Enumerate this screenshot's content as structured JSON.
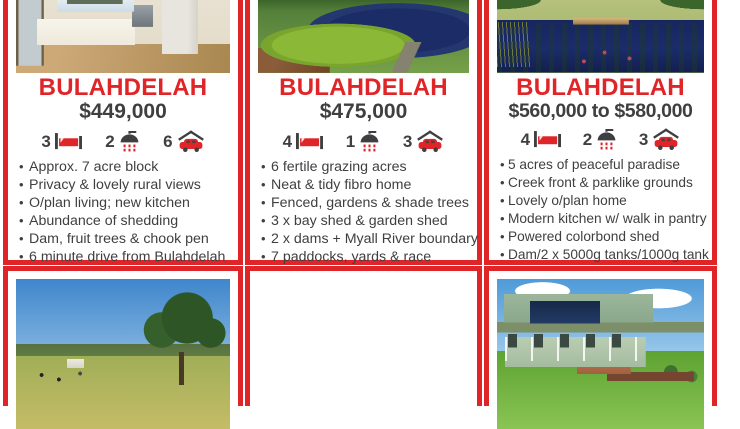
{
  "flyer": {
    "accent_red": "#e02529",
    "text_color": "#3f3f41",
    "stat_icons": [
      "bed-icon",
      "shower-icon",
      "car-icon"
    ],
    "listings": [
      {
        "location": "BULAHDELAH",
        "price": "$449,000",
        "beds": "3",
        "baths": "2",
        "cars": "6",
        "top_photo": "kitchen-interior",
        "bottom_photo": "pasture-with-cattle-and-large-tree",
        "features": [
          "Approx. 7 acre block",
          "Privacy & lovely rural views",
          "O/plan living; new kitchen",
          "Abundance of shedding",
          "Dam, fruit trees & chook pen",
          "6 minute drive from Bulahdelah"
        ]
      },
      {
        "location": "BULAHDELAH",
        "price": "$475,000",
        "beds": "4",
        "baths": "1",
        "cars": "3",
        "top_photo": "dam-with-duckweed-and-fallen-log",
        "bottom_photo": "living-room-with-brick-feature-wall",
        "features": [
          "6 fertile grazing acres",
          "Neat & tidy fibro home",
          "Fenced, gardens & shade trees",
          "3 x bay shed & garden shed",
          "2 x dams + Myall River boundary",
          "7 paddocks, yards & race"
        ]
      },
      {
        "location": "BULAHDELAH",
        "price": "$560,000 to $580,000",
        "beds": "4",
        "baths": "2",
        "cars": "3",
        "top_photo": "pond-with-timber-jetty",
        "bottom_photo": "green-house-with-solar-panels",
        "features": [
          "5 acres of peaceful paradise",
          "Creek front & parklike grounds",
          "Lovely o/plan home",
          "Modern kitchen w/ walk in pantry",
          "Powered colorbond shed",
          "Dam/2 x 5000g tanks/1000g tank"
        ]
      }
    ]
  }
}
